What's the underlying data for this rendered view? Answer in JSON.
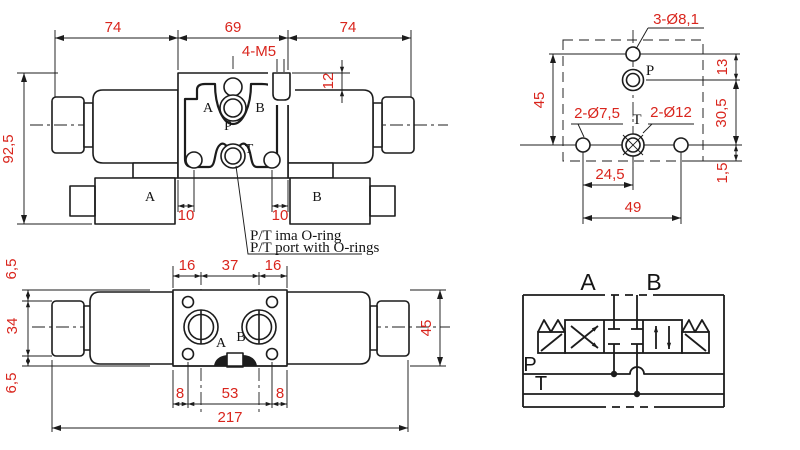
{
  "colors": {
    "dimension_text": "#d9251d",
    "line": "#1c1c1c",
    "background": "#ffffff"
  },
  "front_view": {
    "dim_span_left": "74",
    "dim_span_center": "69",
    "dim_span_right": "74",
    "dim_height": "92,5",
    "thread_callout": "4-M5",
    "dim_stud_offset": "12",
    "dim_port_offset_left": "10",
    "dim_port_offset_right": "10",
    "port_a": "A",
    "port_b": "B",
    "port_p": "P",
    "port_t": "T",
    "connector_a": "A",
    "connector_b": "B"
  },
  "mounting_view": {
    "callout_mount_holes": "3-Ø8,1",
    "callout_locating_holes": "2-Ø7,5",
    "callout_port_holes": "2-Ø12",
    "port_p": "P",
    "port_t": "T",
    "dim_p_offset": "13",
    "dim_height": "45",
    "dim_pt_offset": "30,5",
    "dim_bottom_offset": "1,5",
    "dim_t_spacing": "24,5",
    "dim_hole_spacing": "49"
  },
  "bottom_view": {
    "dim_edge_top": "6,5",
    "dim_nut_width": "34",
    "dim_edge_bottom": "6,5",
    "dim_port_a_offset": "16",
    "dim_port_spacing": "37",
    "dim_port_b_offset": "16",
    "port_a": "A",
    "port_b": "B",
    "dim_hole_offset_left": "8",
    "dim_hole_spacing": "53",
    "dim_hole_offset_right": "8",
    "dim_total_length": "217",
    "dim_height": "45"
  },
  "schematic": {
    "port_a": "A",
    "port_b": "B",
    "port_p": "P",
    "port_t": "T"
  },
  "note": {
    "line1": "P/T ima O-ring",
    "line2": "P/T port with O-rings"
  }
}
